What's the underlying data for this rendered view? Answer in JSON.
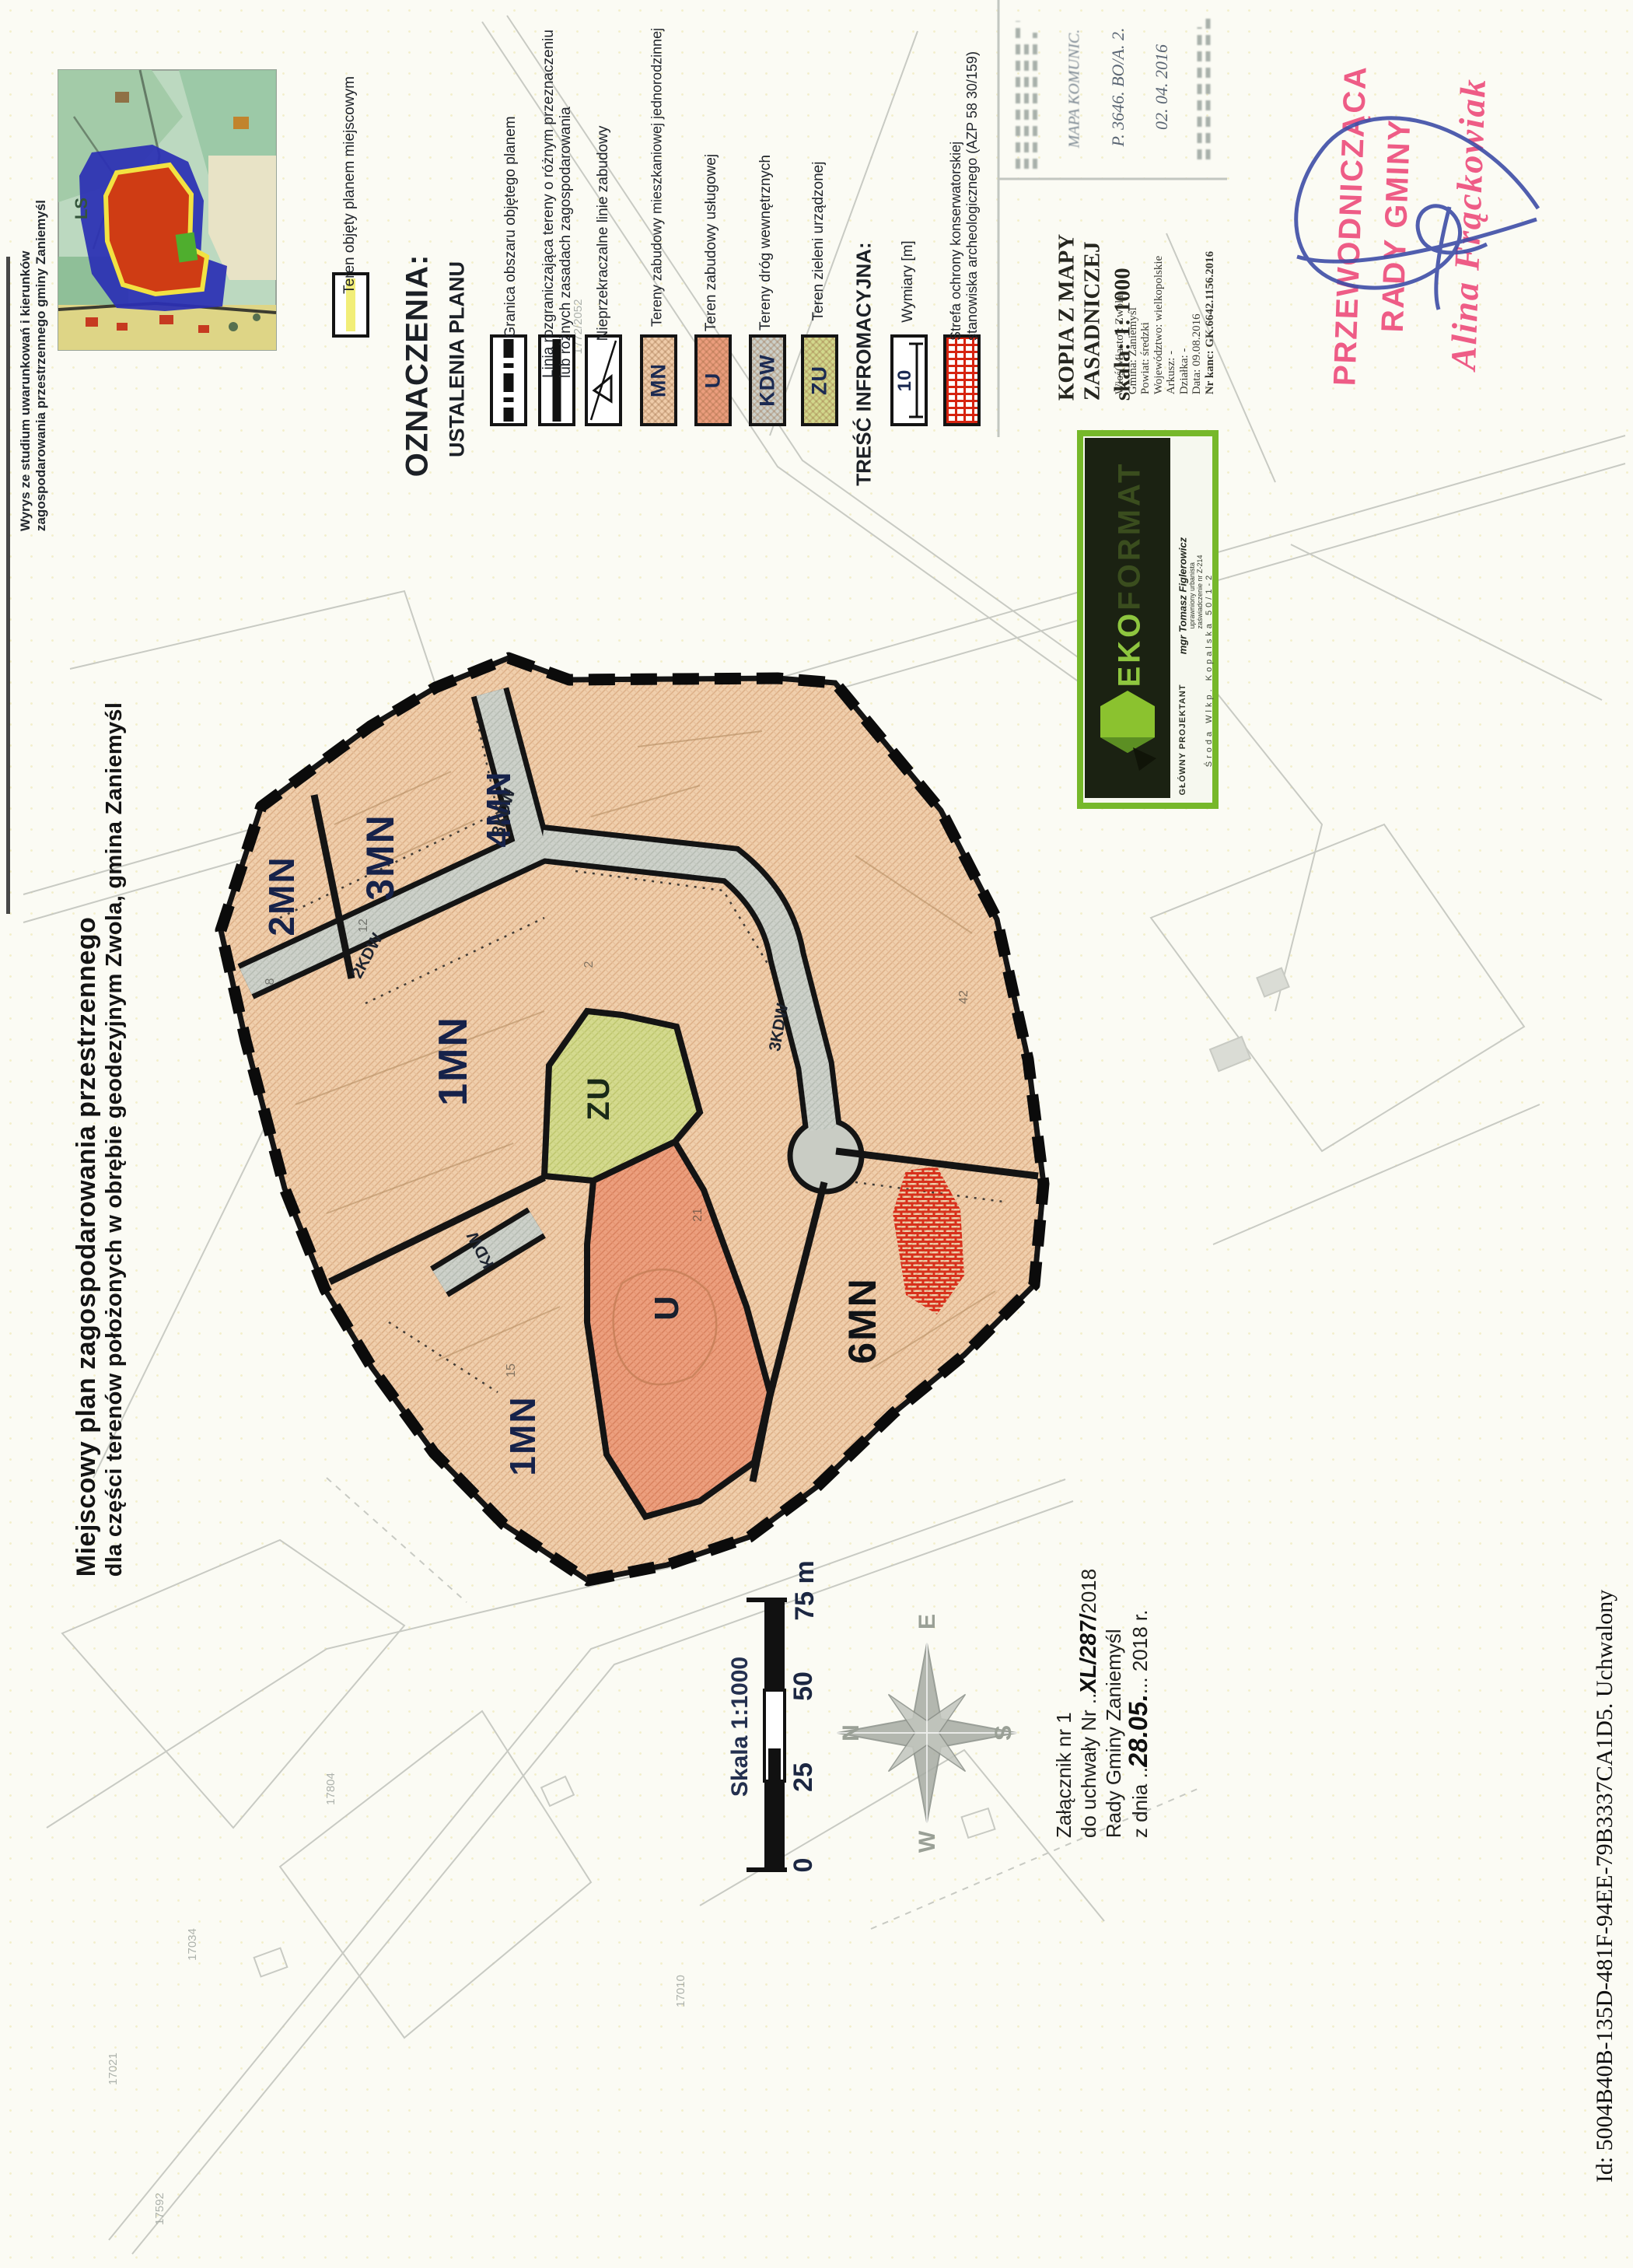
{
  "title": {
    "line1": "Miejscowy plan zagospodarowania przestrzennego",
    "line2": "dla części terenów położonych w obrębie geodezyjnym Zwola, gmina Zaniemyśl"
  },
  "page": {
    "footer_id": "Id: 5004B40B-135D-481F-94EE-79B3337CA1D5. Uchwalony"
  },
  "inset": {
    "caption_line1": "Wyrys ze studium uwarunkowań i kierunków",
    "caption_line2": "zagospodarowania przestrzennego gminy Zaniemyśl",
    "symbol_label": "Teren objęty planem miejscowym",
    "forest_label": "LS"
  },
  "legend": {
    "header": "OZNACZENIA:",
    "subheader": "USTALENIA PLANU",
    "granica_label": "Granica obszaru objętego planem",
    "linia_label1": "Linia rozgraniczająca tereny o różnym przeznaczeniu",
    "linia_label2": "lub różnych zasadach zagospodarowania",
    "zabudowa_label": "Nieprzekraczalne linie zabudowy",
    "mn_code": "MN",
    "mn_label": "Tereny zabudowy mieszkaniowej jednorodzinnej",
    "u_code": "U",
    "u_label": "Teren zabudowy usługowej",
    "kdw_code": "KDW",
    "kdw_label": "Tereny dróg wewnętrznych",
    "zu_code": "ZU",
    "zu_label": "Teren zieleni urządzonej",
    "info_header": "TREŚĆ INFROMACYJNA:",
    "wymiary_symbol": "10",
    "wymiary_label": "Wymiary [m]",
    "strefa_label1": "Strefa ochrony konserwatorskiej",
    "strefa_label2": "stanowiska archeologicznego (AZP 58 30/159)",
    "colors": {
      "mn": "#efccaa",
      "u": "#eb9d7d",
      "kdw": "#ccd0c9",
      "zu": "#d2d88c",
      "strefa": "#d62310"
    }
  },
  "map": {
    "zones": {
      "z2mn": "2MN",
      "z3mn": "3MN",
      "z4mn": "4MN",
      "z1mn_upper": "1MN",
      "zzu": "ZU",
      "zu": "U",
      "z1mn_lower": "1MN",
      "z6mn": "6MN"
    },
    "roads": {
      "r1": "2KDW",
      "r2": "3KDW",
      "r3": "3KDW",
      "r4": "KDW"
    },
    "parcel_numbers": [
      "17021",
      "17034",
      "17592",
      "17804",
      "17010",
      "1772/2052"
    ],
    "small_numbers": [
      "8",
      "12",
      "2",
      "42",
      "15",
      "21"
    ]
  },
  "kopia": {
    "title1": "KOPIA Z MAPY",
    "title2": "ZASADNICZEJ",
    "scale": "skala: 1: 1000",
    "details": [
      "Wieś(Miasto): Zwola",
      "Gmina: Zaniemyśl",
      "Powiat: średzki",
      "Województwo: wielkopolskie",
      "Arkusz: -",
      "Działka: -",
      "Data: 09.08.2016",
      "Nr kanc: GK.6642.1156.2016"
    ]
  },
  "top_stamps": {
    "fragment1": "MAPA KOMUNIC.",
    "fragment2": "P. 3646. BO/A. 2.",
    "fragment3": "02. 04. 2016"
  },
  "ekoformat": {
    "brand_accent": "EKO",
    "brand_rest": "FORMAT",
    "name": "mgr Tomasz Figlerowicz",
    "cred1": "uprawniony urbanista",
    "cred2": "zaświadczenie nr Z-214",
    "role": "GŁÓWNY PROJEKTANT",
    "address": "Środa Wlkp. Kopalska 50/1-2"
  },
  "stamp": {
    "line1": "PRZEWODNICZĄCA",
    "line2": "RADY GMINY",
    "signature": "Alina Frąckowiak",
    "stamp_color": "#ee5c86",
    "pen_color": "#3d4da6"
  },
  "zalacznik": {
    "line1": "Załącznik nr 1",
    "line2_prefix": "do uchwały Nr ..",
    "line2_hand": "XL/287/",
    "line2_suffix": "2018",
    "line3": "Rady Gminy Zaniemyśl",
    "line4_prefix": "z dnia ..",
    "line4_hand": "28.05.",
    "line4_suffix": "... 2018 r."
  },
  "scalebar": {
    "title": "Skala 1:1000",
    "t0": "0",
    "t25": "25",
    "t50": "50",
    "t75": "75 m"
  },
  "compass": {
    "n": "N",
    "e": "E",
    "s": "S",
    "w": "W"
  }
}
